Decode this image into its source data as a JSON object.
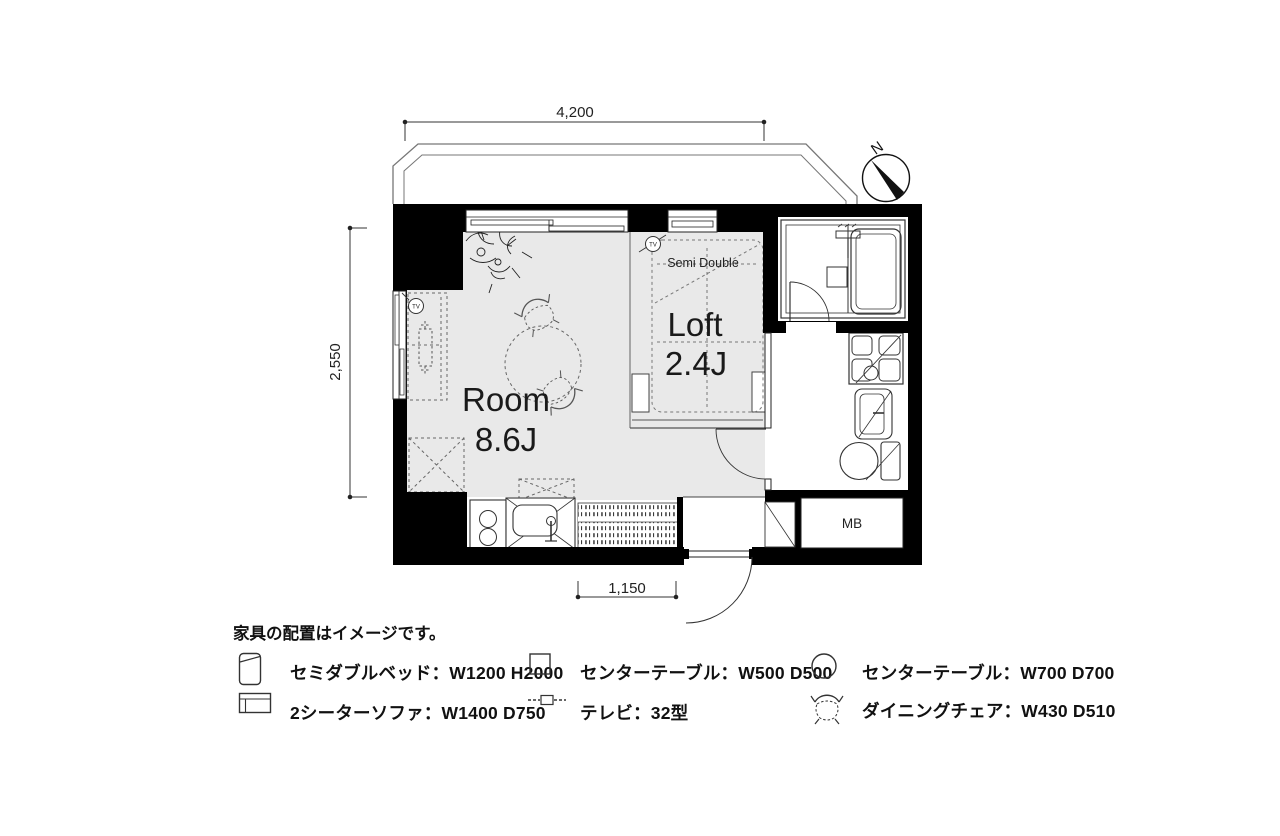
{
  "plan": {
    "room": {
      "name": "Room",
      "size": "8.6J"
    },
    "loft": {
      "name": "Loft",
      "size": "2.4J"
    },
    "bed_label": "Semi Double",
    "meter_box_label": "MB",
    "tv_outlet_label": "TV",
    "compass_label": "N",
    "dimensions": {
      "top": "4,200",
      "left": "2,550",
      "bottom": "1,150"
    },
    "colors": {
      "wall": "#000000",
      "floor": "#e9e9e9",
      "line": "#333333",
      "dashed": "#666666"
    }
  },
  "legend": {
    "note": "家具の配置はイメージです。",
    "items": [
      {
        "name": "semi-double-bed",
        "label": "セミダブルベッド：W1200 H2000"
      },
      {
        "name": "center-table-500",
        "label": "センターテーブル：W500 D500"
      },
      {
        "name": "center-table-700",
        "label": "センターテーブル：W700 D700"
      },
      {
        "name": "two-seater-sofa",
        "label": "2シーターソファ：W1400 D750"
      },
      {
        "name": "tv-32",
        "label": "テレビ：32型"
      },
      {
        "name": "dining-chair",
        "label": "ダイニングチェア：W430 D510"
      }
    ]
  }
}
